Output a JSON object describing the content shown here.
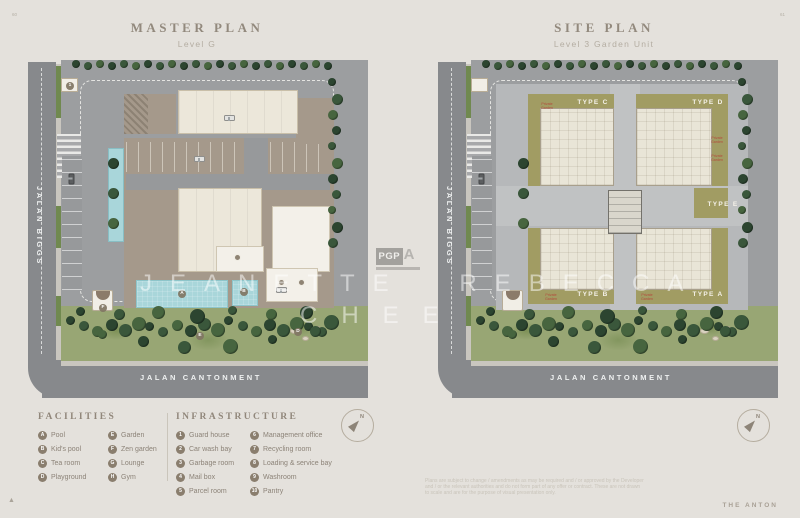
{
  "page": {
    "page_number_left": "60",
    "page_number_right": "61",
    "brand": "THE ANTON",
    "corner_mark": "▲",
    "watermark": {
      "line1": "JEANETTE REBECCA",
      "line2": "CHEE"
    },
    "logo": {
      "text": "PGP",
      "suffix": "A"
    },
    "disclaimer": [
      "Plans are subject to change / amendments as may be required and / or approved by the Developer",
      "and / or the relevant authorities and do not form part of any offer or contract. These are not drawn",
      "to scale and are for the purpose of visual presentation only."
    ]
  },
  "plans": {
    "master": {
      "title": "MASTER PLAN",
      "subtitle": "Level G",
      "road_left": "JALAN BIGGS",
      "road_bottom": "JALAN CANTONMENT",
      "markers": {
        "guard": "1",
        "pool": "A",
        "kids_pool": "B",
        "playground": "D",
        "garden": "E",
        "zen": "F"
      }
    },
    "site": {
      "title": "SITE PLAN",
      "subtitle": "Level 3 Garden Unit",
      "road_left": "JALAN BIGGS",
      "road_bottom": "JALAN CANTONMENT",
      "units": {
        "c": "TYPE C",
        "d": "TYPE D",
        "e": "TYPE E",
        "b": "TYPE B",
        "a": "TYPE A"
      },
      "private_garden": "Private Garden"
    }
  },
  "legend": {
    "facilities": {
      "title": "FACILITIES",
      "items": [
        {
          "key": "A",
          "label": "Pool"
        },
        {
          "key": "B",
          "label": "Kid's pool"
        },
        {
          "key": "C",
          "label": "Tea room"
        },
        {
          "key": "D",
          "label": "Playground"
        },
        {
          "key": "E",
          "label": "Garden"
        },
        {
          "key": "F",
          "label": "Zen garden"
        },
        {
          "key": "G",
          "label": "Lounge"
        },
        {
          "key": "H",
          "label": "Gym"
        }
      ]
    },
    "infrastructure": {
      "title": "INFRASTRUCTURE",
      "items": [
        {
          "key": "1",
          "label": "Guard house"
        },
        {
          "key": "2",
          "label": "Car wash bay"
        },
        {
          "key": "3",
          "label": "Garbage room"
        },
        {
          "key": "4",
          "label": "Mail box"
        },
        {
          "key": "5",
          "label": "Parcel room"
        },
        {
          "key": "6",
          "label": "Management office"
        },
        {
          "key": "7",
          "label": "Recycling room"
        },
        {
          "key": "8",
          "label": "Loading & service bay"
        },
        {
          "key": "9",
          "label": "Washroom"
        },
        {
          "key": "10",
          "label": "Pantry"
        }
      ]
    },
    "compass_n": "N"
  },
  "colors": {
    "background": "#e4e1dc",
    "road": "#87898c",
    "grass": "#98a674",
    "tree": "#2c4530",
    "pool": "#a9d6da",
    "parking_deck": "#a5998b",
    "building": "#ece7da",
    "private_garden_olive": "#a19c63",
    "podium": "#b6b8ba",
    "title_text": "#92897d"
  }
}
